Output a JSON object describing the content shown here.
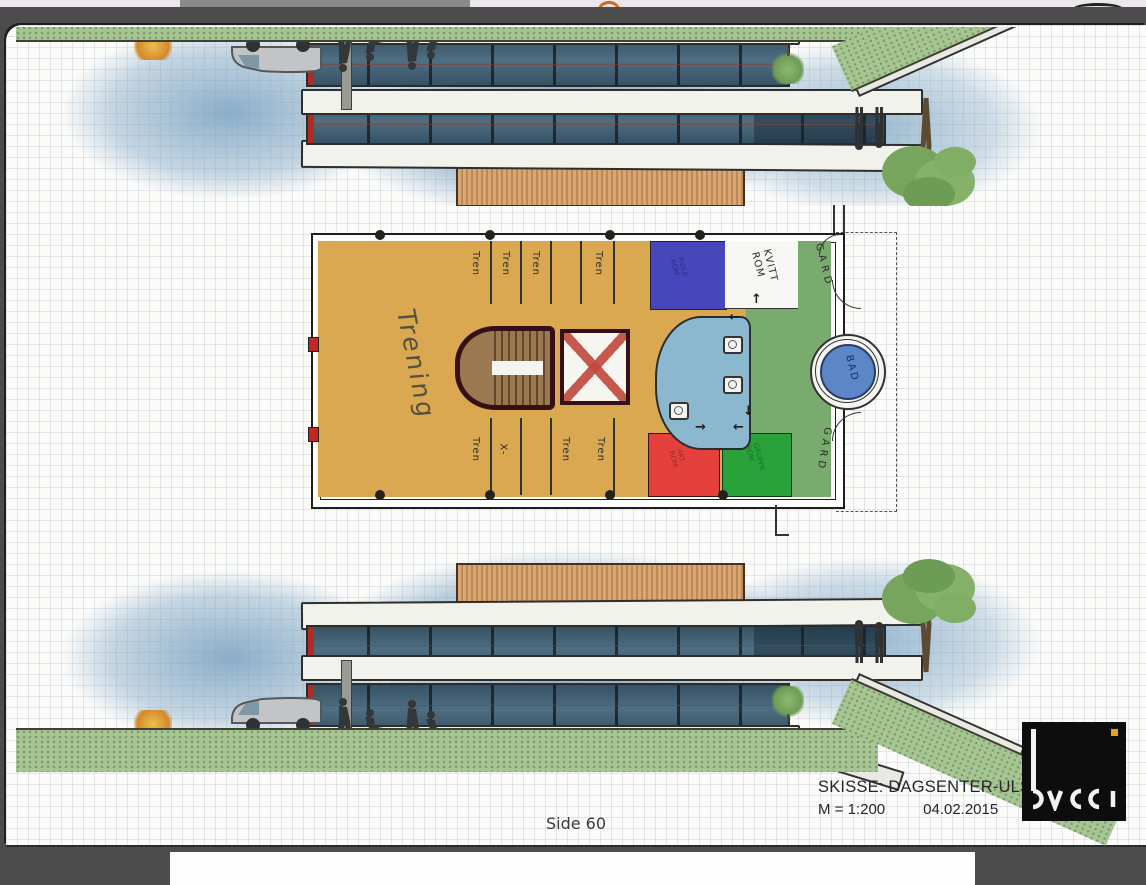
{
  "viewer": {
    "page_caption": "Side 60"
  },
  "sketch": {
    "title_block": {
      "title": "SKISSE: DAGSENTER-ULSTEIN",
      "scale": "M = 1:200",
      "date": "04.02.2015"
    },
    "logo_text": "bucci",
    "plan": {
      "main_hall": "Trening",
      "top_labels": [
        "Tren",
        "Tren",
        "Tren",
        "Tren"
      ],
      "bottom_labels": [
        "Tren",
        "X-",
        "Tren",
        "Tren"
      ],
      "white_room": {
        "line1": "KVITT",
        "line2": "ROM"
      },
      "wardrobe_top": "GARD",
      "wardrobe_bottom": "GARD",
      "bath": "BAD",
      "blue_room": {
        "line1": "KVILE",
        "line2": "ROM"
      },
      "red_room": {
        "line1": "AKT.",
        "line2": "ROM"
      },
      "green_room": {
        "line1": "GRUPPE",
        "line2": "ROM"
      },
      "arrows": {
        "up": "↑",
        "down": "↓",
        "left": "←",
        "right": "→"
      }
    },
    "colors": {
      "hall_orange": "#d9a850",
      "corridor_green": "#79aa6e",
      "group_green": "#2aa23c",
      "room_red": "#e5413c",
      "room_blue": "#4746bd",
      "wet_blue": "#8cb8cf",
      "bath_blue": "#5b86c8",
      "wood": "#d7a474",
      "grass": "#a7c493",
      "sky": "#9dbcd4",
      "logo_accent": "#e8a020"
    }
  }
}
